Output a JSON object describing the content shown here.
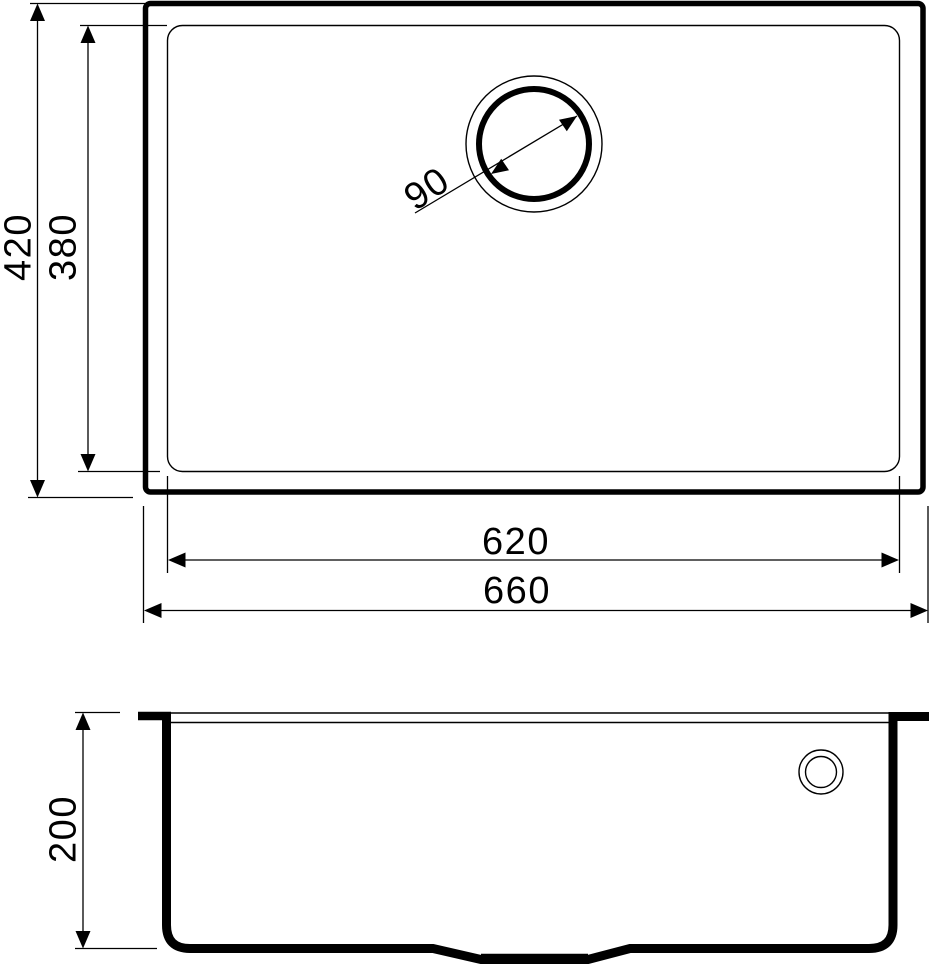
{
  "drawing": {
    "title": "sink-technical-drawing",
    "background_color": "#ffffff",
    "line_color": "#000000",
    "views": {
      "plan": "top view of sink with bowl and drain",
      "section": "front section view of sink bowl"
    },
    "dimensions": {
      "overall_depth": "420",
      "bowl_depth": "380",
      "drain_diameter": "90",
      "bowl_width": "620",
      "overall_width": "660",
      "bowl_height": "200"
    }
  }
}
